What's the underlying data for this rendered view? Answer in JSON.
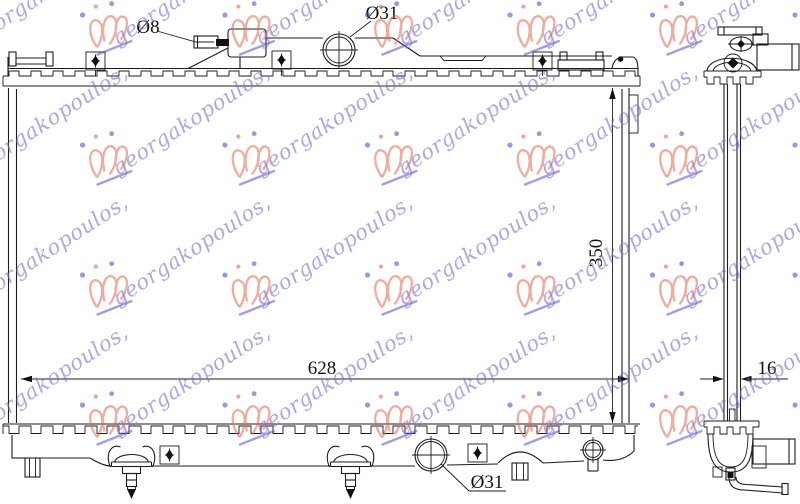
{
  "drawing": {
    "title_note": "radiator technical drawing, front and side views",
    "labels": {
      "overflow_pipe_diameter": "Ø8",
      "filler_neck_diameter": "Ø31",
      "core_width_mm": "628",
      "core_height_mm": "350",
      "core_thickness_mm": "16",
      "drain_diameter": "Ø31"
    },
    "watermark": {
      "text": "georgakopoulos,",
      "text_color": "#7b6ed0",
      "logo_color": "#e26a55",
      "underline_color": "#5a4ec8"
    },
    "line_color": "#1c1c1c",
    "background_color": "#ffffff"
  }
}
